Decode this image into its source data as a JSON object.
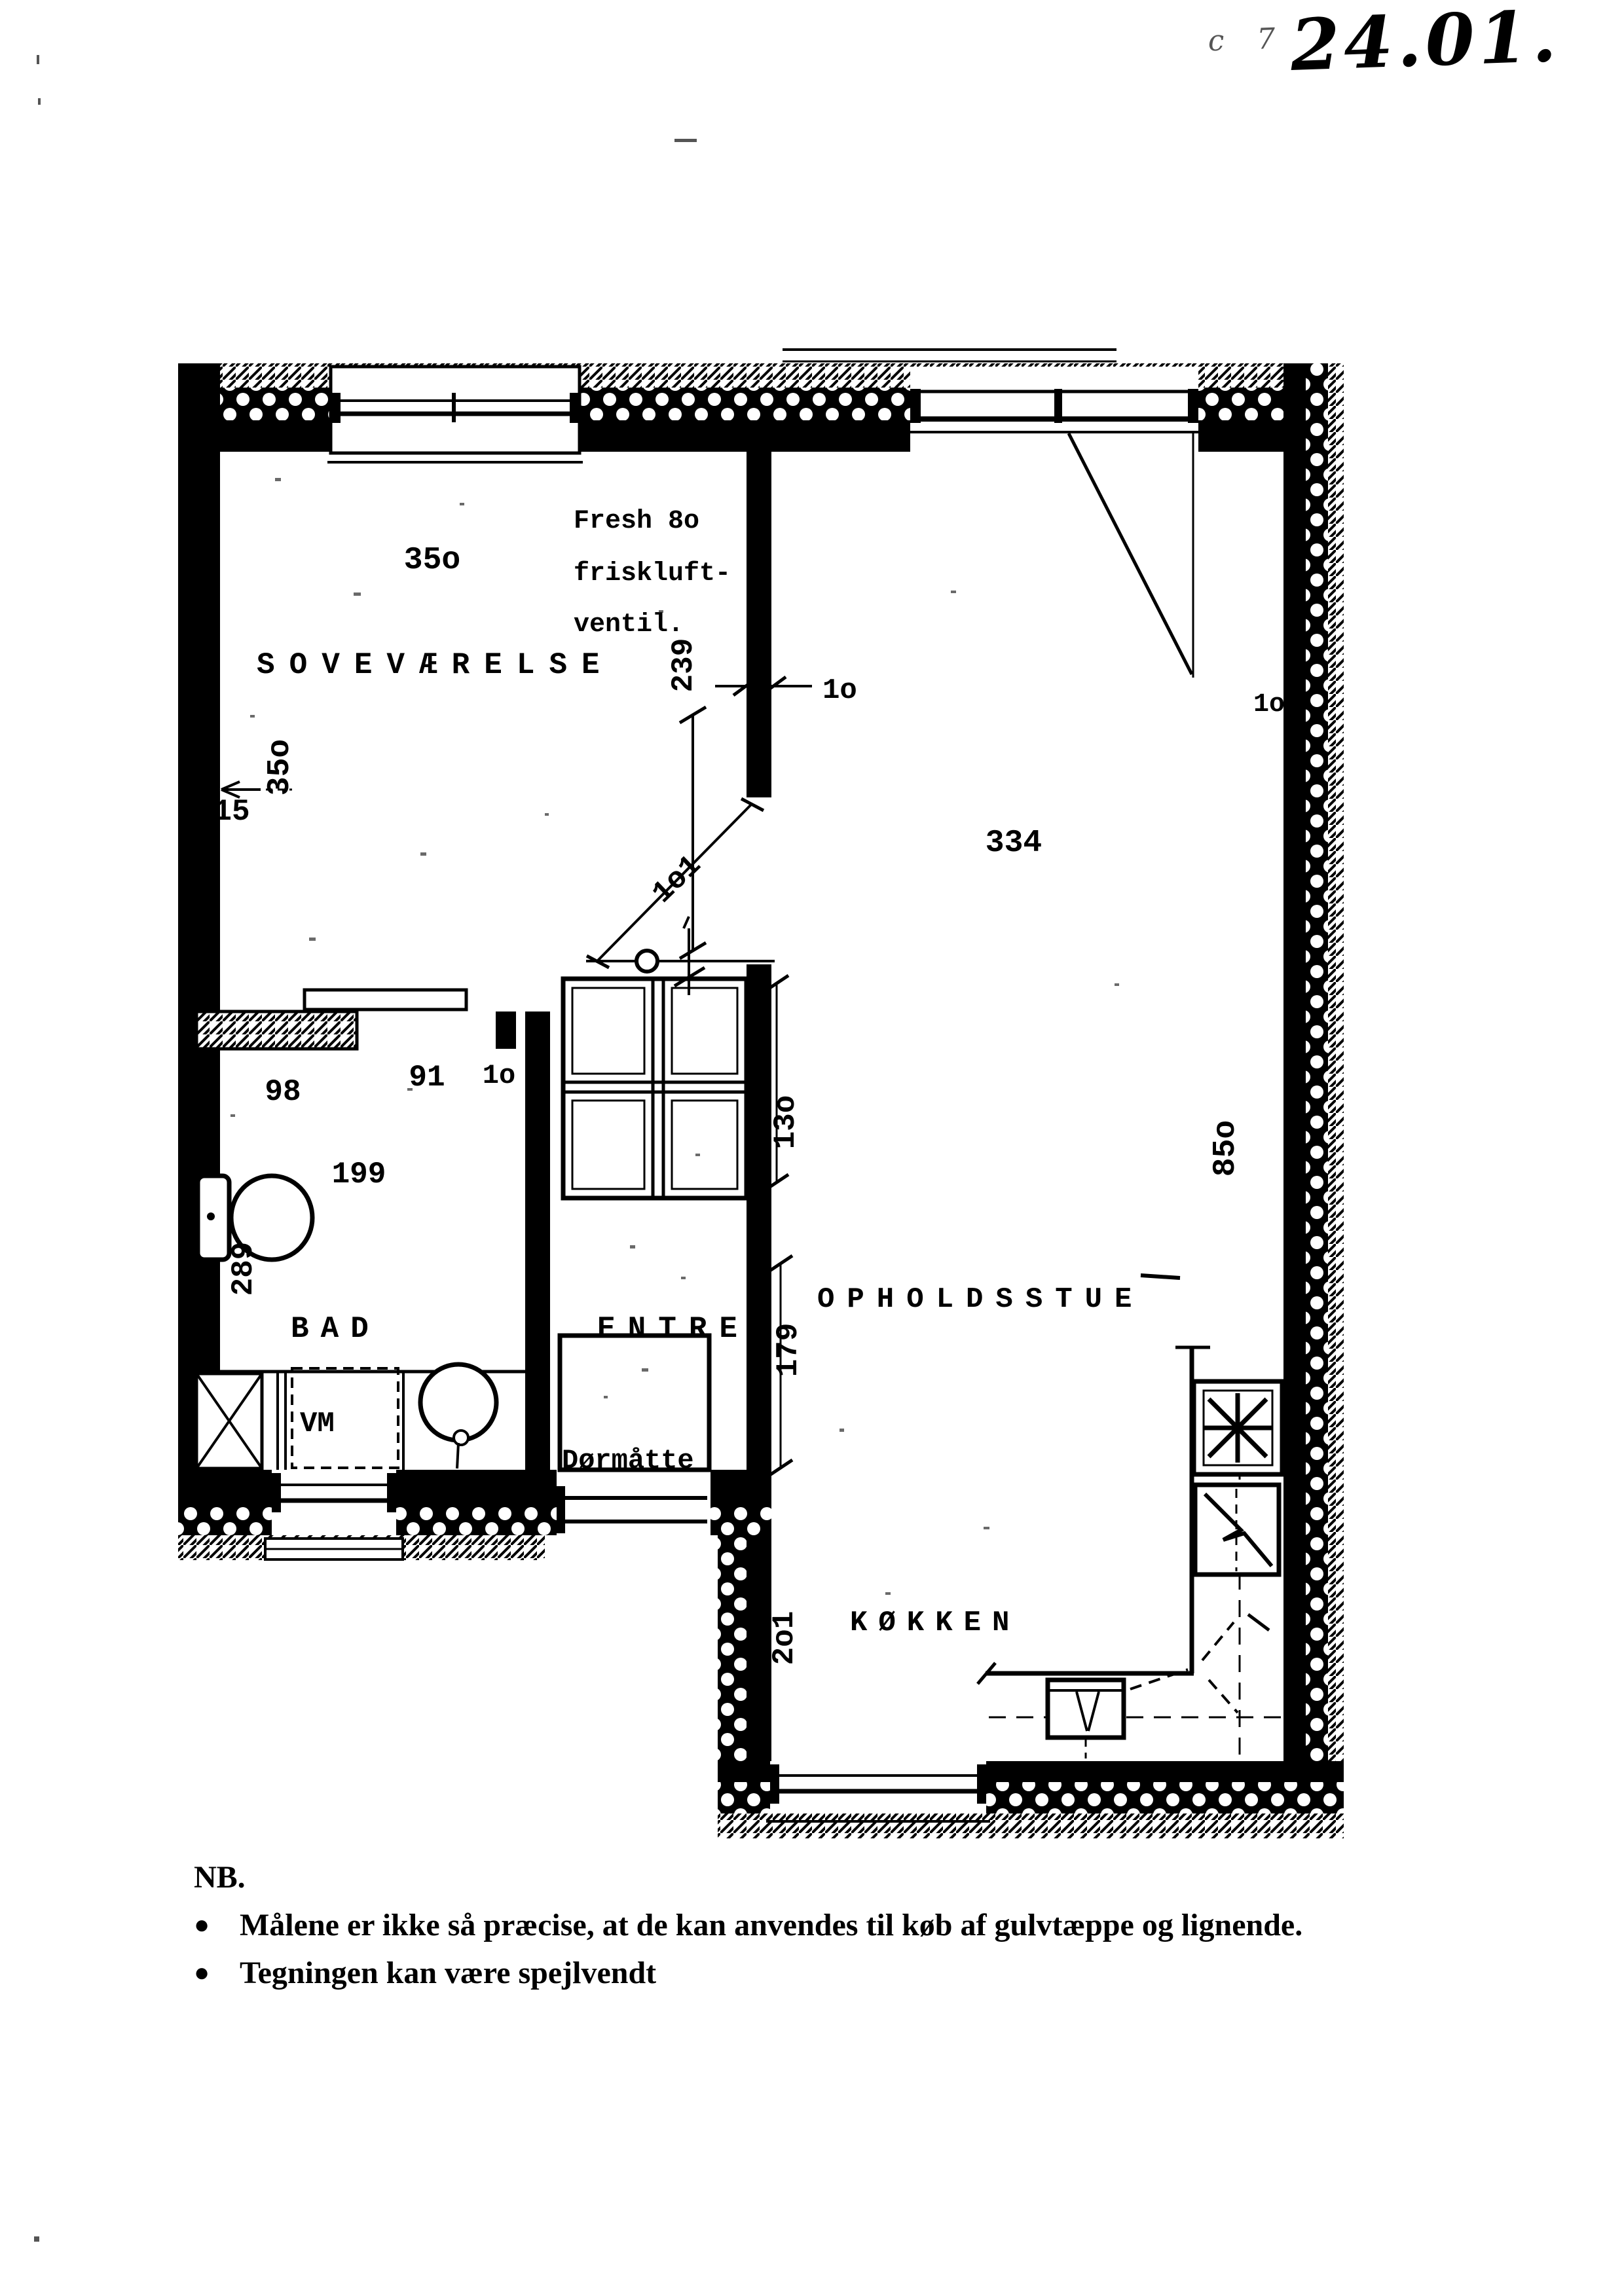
{
  "annotations": {
    "corner_prefix": "c 7",
    "date_mark": "24.01."
  },
  "plan": {
    "rooms": {
      "bedroom": "SOVEVÆRELSE",
      "living": "OPHOLDSSTUE",
      "bath": "BAD",
      "hall": "ENTRE",
      "kitchen": "KØKKEN"
    },
    "fixtures": {
      "washing_machine": "VM",
      "door_mat": "Dørmåtte"
    },
    "vent_note": {
      "line1": "Fresh 8o",
      "line2": "friskluft-",
      "line3": "ventil."
    },
    "dimensions": {
      "bedroom_width_top": "35o",
      "bedroom_depth_side": "35o",
      "wall_niche_15": "15",
      "bedroom_east_239": "239",
      "doorway_10_mid": "1o",
      "living_width_334": "334",
      "right_wall_10": "1o",
      "diag_passage_101": "1o1",
      "bath_wall_98": "98",
      "bath_door_91": "91",
      "bath_stub_10": "1o",
      "bath_width_199": "199",
      "bath_depth_289": "289",
      "hall_pass_130": "13o",
      "hall_wall_179": "179",
      "house_length_850": "85o",
      "kitchen_width_201": "2o1"
    }
  },
  "note": {
    "heading": "NB.",
    "bullets": [
      "Målene er ikke så præcise, at de kan anvendes til køb af gulvtæppe og lignende.",
      "Tegningen kan være spejlvendt"
    ]
  }
}
